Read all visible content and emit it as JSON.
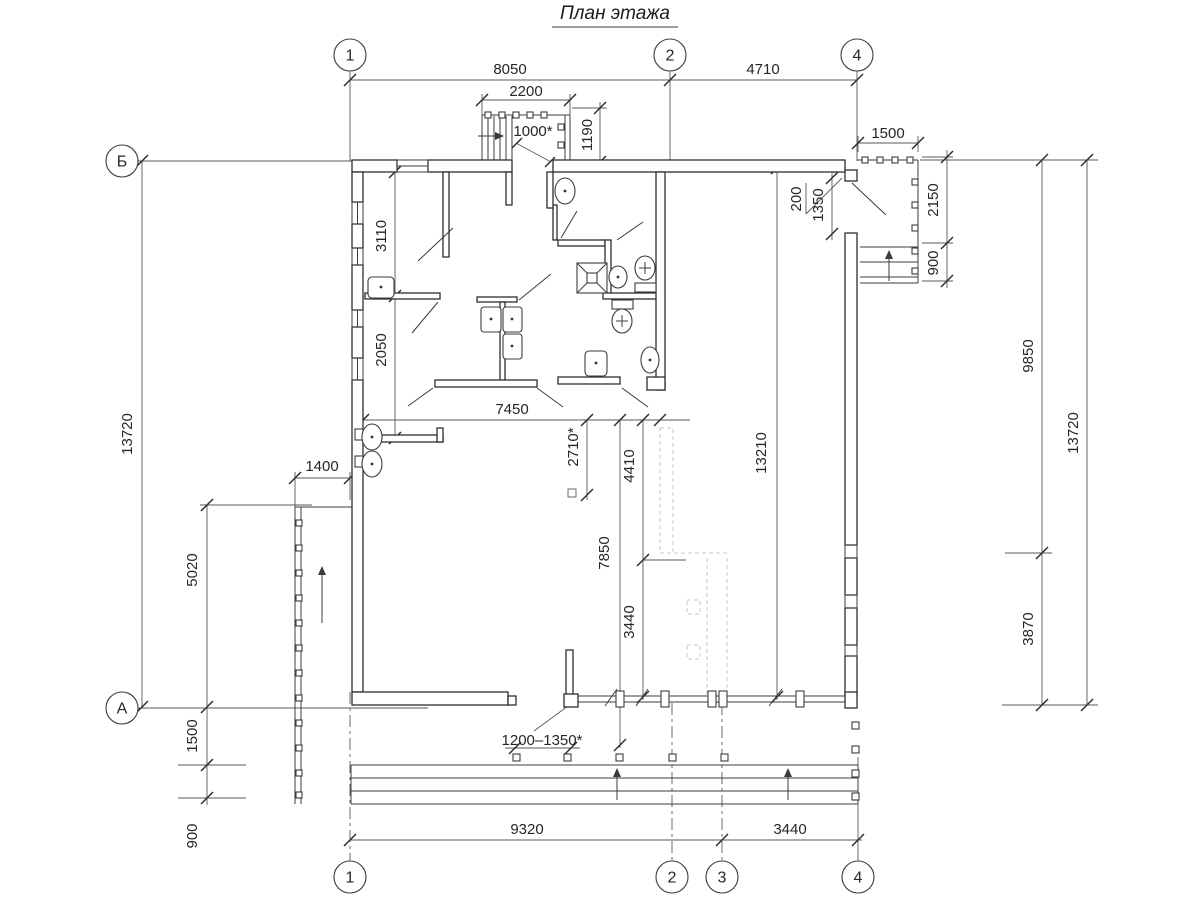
{
  "title": "План этажа",
  "axes": {
    "top": {
      "n1": "1",
      "n2": "2",
      "n4": "4"
    },
    "bottom": {
      "n1": "1",
      "n2": "2",
      "n3": "3",
      "n4": "4"
    },
    "left": {
      "b": "Б",
      "a": "А"
    }
  },
  "dims": {
    "top": {
      "d8050": "8050",
      "d4710": "4710",
      "d2200": "2200",
      "d1190": "1190",
      "d1000": "1000*"
    },
    "right_porch": {
      "d1500": "1500",
      "d2150": "2150",
      "d900": "900",
      "d200": "200",
      "d1350": "1350"
    },
    "right": {
      "d9850": "9850",
      "d3870": "3870",
      "d13720": "13720"
    },
    "left": {
      "d13720": "13720",
      "d5020": "5020",
      "d1400": "1400",
      "d1500": "1500",
      "d900": "900"
    },
    "rooms": {
      "d3110": "3110",
      "d2050": "2050",
      "d7450": "7450",
      "d2710": "2710*",
      "d4410": "4410",
      "d7850": "7850",
      "d3440": "3440",
      "d13210": "13210"
    },
    "bottom": {
      "d9320": "9320",
      "d3440": "3440",
      "drange": "1200–1350*"
    }
  }
}
